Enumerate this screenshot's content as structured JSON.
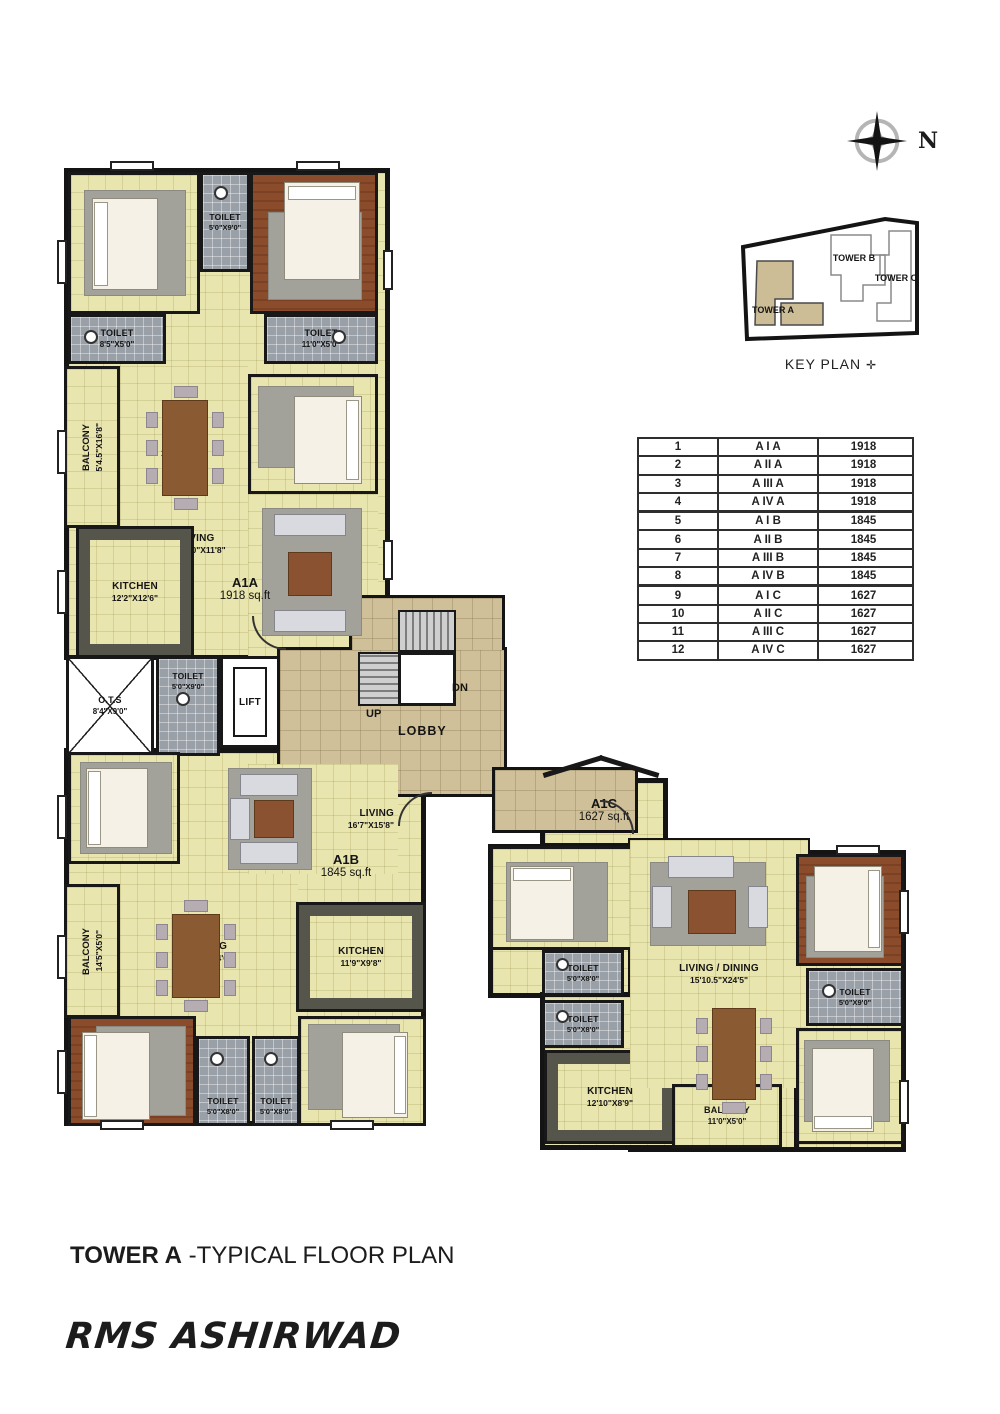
{
  "title": {
    "bold": "TOWER A",
    "rest": " -TYPICAL FLOOR PLAN"
  },
  "logo": "RMS ASHIRWAD",
  "compass": {
    "label": "N"
  },
  "key_plan": {
    "caption": "KEY PLAN",
    "tower_a": "TOWER A",
    "tower_b": "TOWER B",
    "tower_c": "TOWER C"
  },
  "unit_table": {
    "rows": [
      {
        "no": "1",
        "unit": "A I A",
        "area": "1918"
      },
      {
        "no": "2",
        "unit": "A II A",
        "area": "1918"
      },
      {
        "no": "3",
        "unit": "A III A",
        "area": "1918"
      },
      {
        "no": "4",
        "unit": "A IV A",
        "area": "1918"
      },
      {
        "no": "5",
        "unit": "A I B",
        "area": "1845"
      },
      {
        "no": "6",
        "unit": "A II B",
        "area": "1845"
      },
      {
        "no": "7",
        "unit": "A III B",
        "area": "1845"
      },
      {
        "no": "8",
        "unit": "A IV B",
        "area": "1845"
      },
      {
        "no": "9",
        "unit": "A I C",
        "area": "1627"
      },
      {
        "no": "10",
        "unit": "A II C",
        "area": "1627"
      },
      {
        "no": "11",
        "unit": "A III C",
        "area": "1627"
      },
      {
        "no": "12",
        "unit": "A IV C",
        "area": "1627"
      }
    ]
  },
  "core": {
    "ots": {
      "name": "O.T.S",
      "dim": "8'4\"X9'0\""
    },
    "toilet": {
      "name": "TOILET",
      "dim": "5'0\"X9'0\""
    },
    "lift": "LIFT",
    "lobby": "LOBBY",
    "up": "UP",
    "dn": "DN"
  },
  "a1a": {
    "label": "A1A",
    "area": "1918 sq.ft",
    "bed1": {
      "name": "BED 1",
      "dim": "12'7\"X13'10.5\""
    },
    "toilet_top": {
      "name": "TOILET",
      "dim": "5'0\"X9'0\""
    },
    "mbedroom": {
      "name": "M.BEDROOM",
      "dim": "12'8\"X13'10.5\""
    },
    "toilet_left": {
      "name": "TOILET",
      "dim": "8'5\"X5'0\""
    },
    "toilet_right": {
      "name": "TOILET",
      "dim": "11'0\"X5'0\""
    },
    "balcony": {
      "name": "BALCONY",
      "dim": "5'4.5\"X16'8\""
    },
    "dining": {
      "name": "DINING",
      "dim": "12'7\"X16'8\""
    },
    "bed2": {
      "name": "BED 2",
      "dim": "12'3\"X12'9\""
    },
    "living": {
      "name": "LIVING",
      "dim": "18'0\"X11'8\""
    },
    "kitchen": {
      "name": "KITCHEN",
      "dim": "12'2\"X12'6\""
    }
  },
  "a1b": {
    "label": "A1B",
    "area": "1845 sq.ft",
    "bed1": {
      "name": "BED 1",
      "dim": "14'5\"X10'10.5\""
    },
    "living": {
      "name": "LIVING",
      "dim": "16'7\"X15'8\""
    },
    "balcony": {
      "name": "BALCONY",
      "dim": "14'5\"X5'0\""
    },
    "dining": {
      "name": "DINING",
      "dim": "17'8\"X14'6\""
    },
    "kitchen": {
      "name": "KITCHEN",
      "dim": "11'9\"X9'8\""
    },
    "mbed": {
      "name": "M.BED",
      "dim": "12'3\"X13'6\""
    },
    "toilet1": {
      "name": "TOILET",
      "dim": "5'0\"X8'0\""
    },
    "toilet2": {
      "name": "TOILET",
      "dim": "5'0\"X8'0\""
    },
    "bed2": {
      "name": "BED 2",
      "dim": "12'3\"X11'6\""
    }
  },
  "a1c": {
    "label": "A1C",
    "area": "1627 sq.ft",
    "bed1": {
      "name": "BED 1",
      "dim": "13'5\"X10'0\""
    },
    "toilet1": {
      "name": "TOILET",
      "dim": "5'0\"X8'0\""
    },
    "toilet2": {
      "name": "TOILET",
      "dim": "5'0\"X8'0\""
    },
    "living_dining": {
      "name": "LIVING / DINING",
      "dim": "15'10.5\"X24'5\""
    },
    "kitchen": {
      "name": "KITCHEN",
      "dim": "12'10\"X8'9\""
    },
    "balcony": {
      "name": "BALCONY",
      "dim": "11'0\"X5'0\""
    },
    "mbed": {
      "name": "M.BED",
      "dim": "11'8\"X11'6\""
    },
    "toilet3": {
      "name": "TOILET",
      "dim": "5'0\"X9'0\""
    },
    "bed2": {
      "name": "BED 2",
      "dim": "11'7.5\"X11'6\""
    }
  },
  "colors": {
    "floor_cream": "#e9e5ae",
    "floor_lobby": "#cfc09a",
    "floor_toilet": "#9aa0a8",
    "floor_wood": "#8a4c2a",
    "wall": "#141414",
    "keyplan_fill": "#cdbd97"
  }
}
